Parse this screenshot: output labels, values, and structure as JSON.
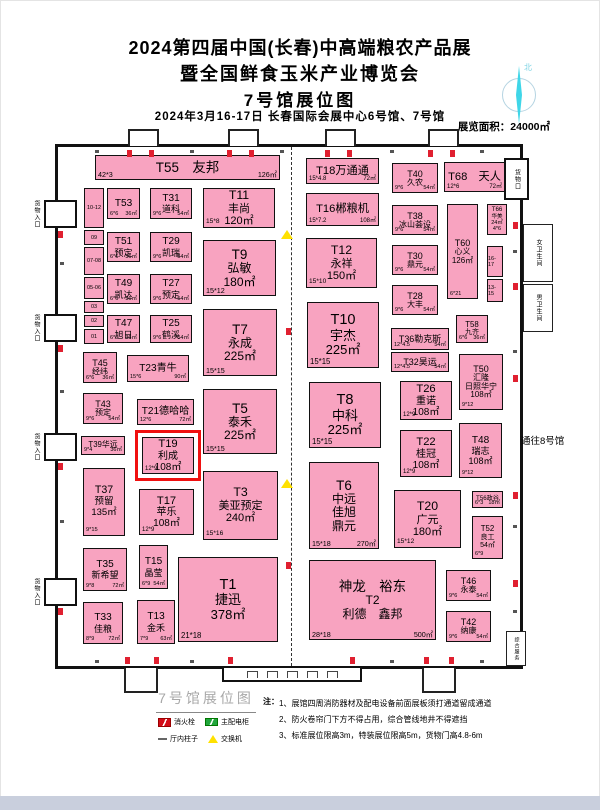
{
  "header": {
    "title_line1": "2024第四届中国(长春)中高端粮农产品展",
    "title_line2": "暨全国鲜食玉米产业博览会",
    "title_line3": "7号馆展位图",
    "subtitle": "2024年3月16-17日  长春国际会展中心6号馆、7号馆",
    "area_label": "展览面积：24000㎡",
    "compass_north": "北"
  },
  "hall": {
    "booths": [
      {
        "id": "T55",
        "x": 95,
        "y": 155,
        "w": 185,
        "h": 25,
        "fs": 12,
        "lines": [
          "T55　友邦"
        ],
        "bl": "42*3",
        "br": "126㎡"
      },
      {
        "id": "T53",
        "x": 107,
        "y": 188,
        "w": 33,
        "h": 31,
        "fs": 9,
        "lines": [
          "T53"
        ],
        "bl": "6*6",
        "br": "36㎡"
      },
      {
        "id": "T51",
        "x": 107,
        "y": 232,
        "w": 33,
        "h": 30,
        "fs": 9,
        "lines": [
          "T51",
          "预定"
        ],
        "bl": "6*6",
        "br": "36㎡"
      },
      {
        "id": "T49",
        "x": 107,
        "y": 274,
        "w": 33,
        "h": 30,
        "fs": 9,
        "lines": [
          "T49",
          "凯达"
        ],
        "bl": "6*6",
        "br": "36㎡"
      },
      {
        "id": "T47",
        "x": 107,
        "y": 315,
        "w": 33,
        "h": 28,
        "fs": 9,
        "lines": [
          "T47",
          "旭日"
        ],
        "bl": "6*6",
        "br": "36㎡"
      },
      {
        "id": "T31",
        "x": 150,
        "y": 188,
        "w": 42,
        "h": 31,
        "fs": 9,
        "lines": [
          "T31",
          "道科"
        ],
        "bl": "9*6",
        "br": "54㎡"
      },
      {
        "id": "T29",
        "x": 150,
        "y": 232,
        "w": 42,
        "h": 30,
        "fs": 9,
        "lines": [
          "T29",
          "凯瑞"
        ],
        "bl": "9*6",
        "br": "54㎡"
      },
      {
        "id": "T27",
        "x": 150,
        "y": 274,
        "w": 42,
        "h": 30,
        "fs": 9,
        "lines": [
          "T27",
          "预定"
        ],
        "bl": "9*6",
        "br": "54㎡"
      },
      {
        "id": "T25",
        "x": 150,
        "y": 315,
        "w": 42,
        "h": 28,
        "fs": 9,
        "lines": [
          "T25",
          "鹤溪"
        ],
        "bl": "9*6",
        "br": "54㎡"
      },
      {
        "id": "T11",
        "x": 203,
        "y": 188,
        "w": 72,
        "h": 40,
        "fs": 11,
        "lines": [
          "T11",
          "丰尚",
          "120㎡"
        ],
        "bl": "15*8"
      },
      {
        "id": "T9",
        "x": 203,
        "y": 240,
        "w": 73,
        "h": 56,
        "fs": 12,
        "lines": [
          "T9",
          "弘敏",
          "180㎡"
        ],
        "bl": "15*12"
      },
      {
        "id": "T45",
        "x": 83,
        "y": 352,
        "w": 34,
        "h": 31,
        "fs": 8,
        "lines": [
          "T45",
          "经纬"
        ],
        "bl": "6*6",
        "br": "36㎡"
      },
      {
        "id": "T23",
        "x": 127,
        "y": 355,
        "w": 62,
        "h": 27,
        "fs": 9,
        "lines": [
          "T23青牛"
        ],
        "bl": "15*6",
        "br": "90㎡"
      },
      {
        "id": "T7",
        "x": 203,
        "y": 309,
        "w": 74,
        "h": 67,
        "fs": 12,
        "lines": [
          "T7",
          "永成",
          "225㎡"
        ],
        "bl": "15*15"
      },
      {
        "id": "T43",
        "x": 83,
        "y": 393,
        "w": 40,
        "h": 31,
        "fs": 8,
        "lines": [
          "T43",
          "预定"
        ],
        "bl": "9*6",
        "br": "54㎡"
      },
      {
        "id": "T21",
        "x": 137,
        "y": 399,
        "w": 57,
        "h": 26,
        "fs": 9,
        "lines": [
          "T21德哈哈"
        ],
        "bl": "12*6",
        "br": "72㎡"
      },
      {
        "id": "T5",
        "x": 203,
        "y": 389,
        "w": 74,
        "h": 65,
        "fs": 12,
        "lines": [
          "T5",
          "泰禾",
          "225㎡"
        ],
        "bl": "15*15"
      },
      {
        "id": "T39",
        "x": 81,
        "y": 436,
        "w": 44,
        "h": 19,
        "fs": 7,
        "lines": [
          "T39华远"
        ],
        "bl": "9*4",
        "br": "36㎡"
      },
      {
        "id": "T19",
        "x": 142,
        "y": 437,
        "w": 52,
        "h": 37,
        "fs": 10,
        "hl": true,
        "lines": [
          "T19",
          "利成",
          "108㎡"
        ],
        "bl": "12*9"
      },
      {
        "id": "T37",
        "x": 83,
        "y": 468,
        "w": 42,
        "h": 68,
        "fs": 9.5,
        "lines": [
          "T37",
          "预留",
          "135㎡"
        ],
        "bl": "9*15"
      },
      {
        "id": "T17",
        "x": 139,
        "y": 489,
        "w": 55,
        "h": 46,
        "fs": 10,
        "lines": [
          "T17",
          "苹乐",
          "108㎡"
        ],
        "bl": "12*9"
      },
      {
        "id": "T3",
        "x": 203,
        "y": 471,
        "w": 75,
        "h": 69,
        "fs": 11,
        "lines": [
          "T3",
          "美亚预定",
          "240㎡"
        ],
        "bl": "15*16"
      },
      {
        "id": "T35",
        "x": 83,
        "y": 548,
        "w": 44,
        "h": 43,
        "fs": 9,
        "lines": [
          "T35",
          "新希望"
        ],
        "bl": "9*8",
        "br": "72㎡"
      },
      {
        "id": "T15",
        "x": 139,
        "y": 545,
        "w": 29,
        "h": 44,
        "fs": 9,
        "lines": [
          "T15",
          "晶莹"
        ],
        "bl": "6*9",
        "br": "54㎡"
      },
      {
        "id": "T1",
        "x": 178,
        "y": 557,
        "w": 100,
        "h": 85,
        "fs": 13,
        "lines": [
          "T1",
          "捷迅",
          "378㎡"
        ],
        "bl": "21*18"
      },
      {
        "id": "T33",
        "x": 83,
        "y": 602,
        "w": 40,
        "h": 42,
        "fs": 9,
        "lines": [
          "T33",
          "佳粮"
        ],
        "bl": "8*9",
        "br": "72㎡"
      },
      {
        "id": "T13",
        "x": 137,
        "y": 600,
        "w": 38,
        "h": 44,
        "fs": 9,
        "lines": [
          "T13",
          "金禾"
        ],
        "bl": "7*9",
        "br": "63㎡"
      },
      {
        "id": "T18",
        "x": 306,
        "y": 158,
        "w": 73,
        "h": 26,
        "fs": 10,
        "lines": [
          "T18万通通"
        ],
        "bl": "15*4.8",
        "br": "72㎡"
      },
      {
        "id": "T16",
        "x": 306,
        "y": 193,
        "w": 73,
        "h": 33,
        "fs": 10,
        "lines": [
          "T16郴粮机"
        ],
        "bl": "15*7.2",
        "br": "108㎡"
      },
      {
        "id": "T12",
        "x": 306,
        "y": 238,
        "w": 71,
        "h": 50,
        "fs": 11,
        "lines": [
          "T12",
          "永祥",
          "150㎡"
        ],
        "bl": "15*10"
      },
      {
        "id": "T10",
        "x": 307,
        "y": 302,
        "w": 72,
        "h": 66,
        "fs": 13,
        "lines": [
          "T10",
          "宇杰",
          "225㎡"
        ],
        "bl": "15*15"
      },
      {
        "id": "T8",
        "x": 309,
        "y": 382,
        "w": 72,
        "h": 66,
        "fs": 13,
        "lines": [
          "T8",
          "中科",
          "225㎡"
        ],
        "bl": "15*15"
      },
      {
        "id": "T6",
        "x": 309,
        "y": 462,
        "w": 70,
        "h": 87,
        "fs": 12,
        "lines": [
          "T6",
          "中远",
          "佳旭",
          "鼎元"
        ],
        "bl": "15*18",
        "br": "270㎡"
      },
      {
        "id": "T2",
        "x": 309,
        "y": 560,
        "w": 127,
        "h": 80,
        "fs": 12,
        "lines": [
          "神龙　裕东",
          "T2",
          "利德　鑫邦"
        ],
        "bl": "28*18",
        "br": "500㎡"
      },
      {
        "id": "T40",
        "x": 392,
        "y": 163,
        "w": 46,
        "h": 30,
        "fs": 8,
        "lines": [
          "T40",
          "久农"
        ],
        "bl": "9*6",
        "br": "54㎡"
      },
      {
        "id": "T38",
        "x": 392,
        "y": 205,
        "w": 46,
        "h": 30,
        "fs": 8,
        "lines": [
          "T38",
          "冰山荟设"
        ],
        "bl": "9*6",
        "br": "54㎡"
      },
      {
        "id": "T30",
        "x": 392,
        "y": 245,
        "w": 46,
        "h": 30,
        "fs": 8,
        "lines": [
          "T30",
          "鼎元"
        ],
        "bl": "9*6",
        "br": "54㎡"
      },
      {
        "id": "T28",
        "x": 392,
        "y": 285,
        "w": 46,
        "h": 30,
        "fs": 8,
        "lines": [
          "T28",
          "大丰"
        ],
        "bl": "9*6",
        "br": "54㎡"
      },
      {
        "id": "T36",
        "x": 391,
        "y": 328,
        "w": 58,
        "h": 22,
        "fs": 8,
        "lines": [
          "T36勒克斯"
        ],
        "bl": "12*4.5",
        "br": "54㎡"
      },
      {
        "id": "T32",
        "x": 391,
        "y": 352,
        "w": 58,
        "h": 20,
        "fs": 8,
        "lines": [
          "T32昊运"
        ],
        "bl": "12*4.5",
        "br": "54㎡"
      },
      {
        "id": "T26",
        "x": 400,
        "y": 381,
        "w": 52,
        "h": 39,
        "fs": 10,
        "lines": [
          "T26",
          "重诺",
          "108㎡"
        ],
        "bl": "12*9"
      },
      {
        "id": "T22",
        "x": 400,
        "y": 430,
        "w": 52,
        "h": 47,
        "fs": 10,
        "lines": [
          "T22",
          "桂冠",
          "108㎡"
        ],
        "bl": "12*9"
      },
      {
        "id": "T20",
        "x": 394,
        "y": 490,
        "w": 67,
        "h": 58,
        "fs": 11,
        "lines": [
          "T20",
          "广元",
          "180㎡"
        ],
        "bl": "15*12"
      },
      {
        "id": "T68",
        "x": 444,
        "y": 162,
        "w": 61,
        "h": 30,
        "fs": 10,
        "lines": [
          "T68　天人"
        ],
        "bl": "12*6",
        "br": "72㎡"
      },
      {
        "id": "T60",
        "x": 447,
        "y": 204,
        "w": 31,
        "h": 95,
        "fs": 8,
        "lines": [
          "T60",
          "心义",
          "126㎡"
        ],
        "bl": "6*21"
      },
      {
        "id": "T66",
        "x": 487,
        "y": 204,
        "w": 20,
        "h": 31,
        "fs": 5.5,
        "lines": [
          "T66",
          "华美",
          "24㎡",
          "4*6"
        ]
      },
      {
        "id": "T58",
        "x": 456,
        "y": 315,
        "w": 32,
        "h": 28,
        "fs": 7,
        "lines": [
          "T58",
          "九齐"
        ],
        "bl": "6*6",
        "br": "36㎡"
      },
      {
        "id": "T50",
        "x": 459,
        "y": 354,
        "w": 44,
        "h": 56,
        "fs": 8,
        "lines": [
          "T50",
          "汇隆",
          "日照华宁",
          "108㎡"
        ],
        "bl": "9*12"
      },
      {
        "id": "T48",
        "x": 459,
        "y": 423,
        "w": 43,
        "h": 55,
        "fs": 9,
        "lines": [
          "T48",
          "瑞志",
          "108㎡"
        ],
        "bl": "9*12"
      },
      {
        "id": "T56",
        "x": 472,
        "y": 491,
        "w": 31,
        "h": 17,
        "fs": 5.5,
        "lines": [
          "T56政谷"
        ],
        "bl": "6*3",
        "br": "18㎡"
      },
      {
        "id": "T52",
        "x": 472,
        "y": 516,
        "w": 31,
        "h": 43,
        "fs": 7,
        "lines": [
          "T52",
          "良工",
          "54㎡"
        ],
        "bl": "6*9"
      },
      {
        "id": "T46",
        "x": 446,
        "y": 570,
        "w": 45,
        "h": 31,
        "fs": 8,
        "lines": [
          "T46",
          "永泰"
        ],
        "bl": "9*6",
        "br": "54㎡"
      },
      {
        "id": "T42",
        "x": 446,
        "y": 611,
        "w": 45,
        "h": 31,
        "fs": 8,
        "lines": [
          "T42",
          "纳康"
        ],
        "bl": "9*6",
        "br": "54㎡"
      }
    ],
    "mini_booths": [
      {
        "label": "10-12",
        "x": 84,
        "y": 188,
        "w": 20,
        "h": 40
      },
      {
        "label": "09",
        "x": 84,
        "y": 230,
        "w": 20,
        "h": 15
      },
      {
        "label": "07-08",
        "x": 84,
        "y": 247,
        "w": 20,
        "h": 28
      },
      {
        "label": "05-06",
        "x": 84,
        "y": 277,
        "w": 20,
        "h": 22
      },
      {
        "label": "03",
        "x": 84,
        "y": 301,
        "w": 20,
        "h": 12
      },
      {
        "label": "02",
        "x": 84,
        "y": 315,
        "w": 20,
        "h": 12
      },
      {
        "label": "01",
        "x": 84,
        "y": 329,
        "w": 20,
        "h": 15
      },
      {
        "label": "16-17",
        "x": 487,
        "y": 246,
        "w": 16,
        "h": 31
      },
      {
        "label": "13-15",
        "x": 487,
        "y": 279,
        "w": 16,
        "h": 23
      }
    ],
    "wall_labels": {
      "goods_entrance": "货物入口",
      "goods_door": "货物口",
      "to_hall8": "通往8号馆",
      "restroom_women": "女卫生间",
      "restroom_men": "男卫生间",
      "service": "综合服务"
    }
  },
  "legend": {
    "title": "7号馆展位图",
    "items": [
      {
        "icon": "fire-hydrant",
        "label": "消火栓"
      },
      {
        "icon": "main-power-cabinet",
        "label": "主配电柜"
      },
      {
        "icon": "hall-pillar",
        "label": "厅内柱子"
      },
      {
        "icon": "switch",
        "label": "交换机"
      }
    ],
    "notes_prefix": "注：",
    "notes": [
      "1、展馆四周消防器材及配电设备前面展板须打通道留成通道",
      "2、防火卷帘门下方不得占用，综合管线地井不得遮挡",
      "3、标准展位限高3m，特装展位限高5m，货物门高4.8-6m"
    ]
  },
  "colors": {
    "booth_pink": "#F8A3C0",
    "highlight_red": "#F01010",
    "hydrant_red": "#E02030",
    "switch_yellow": "#FFE100",
    "power_green": "#21A63C",
    "compass_cyan": "#3FD6E8"
  }
}
